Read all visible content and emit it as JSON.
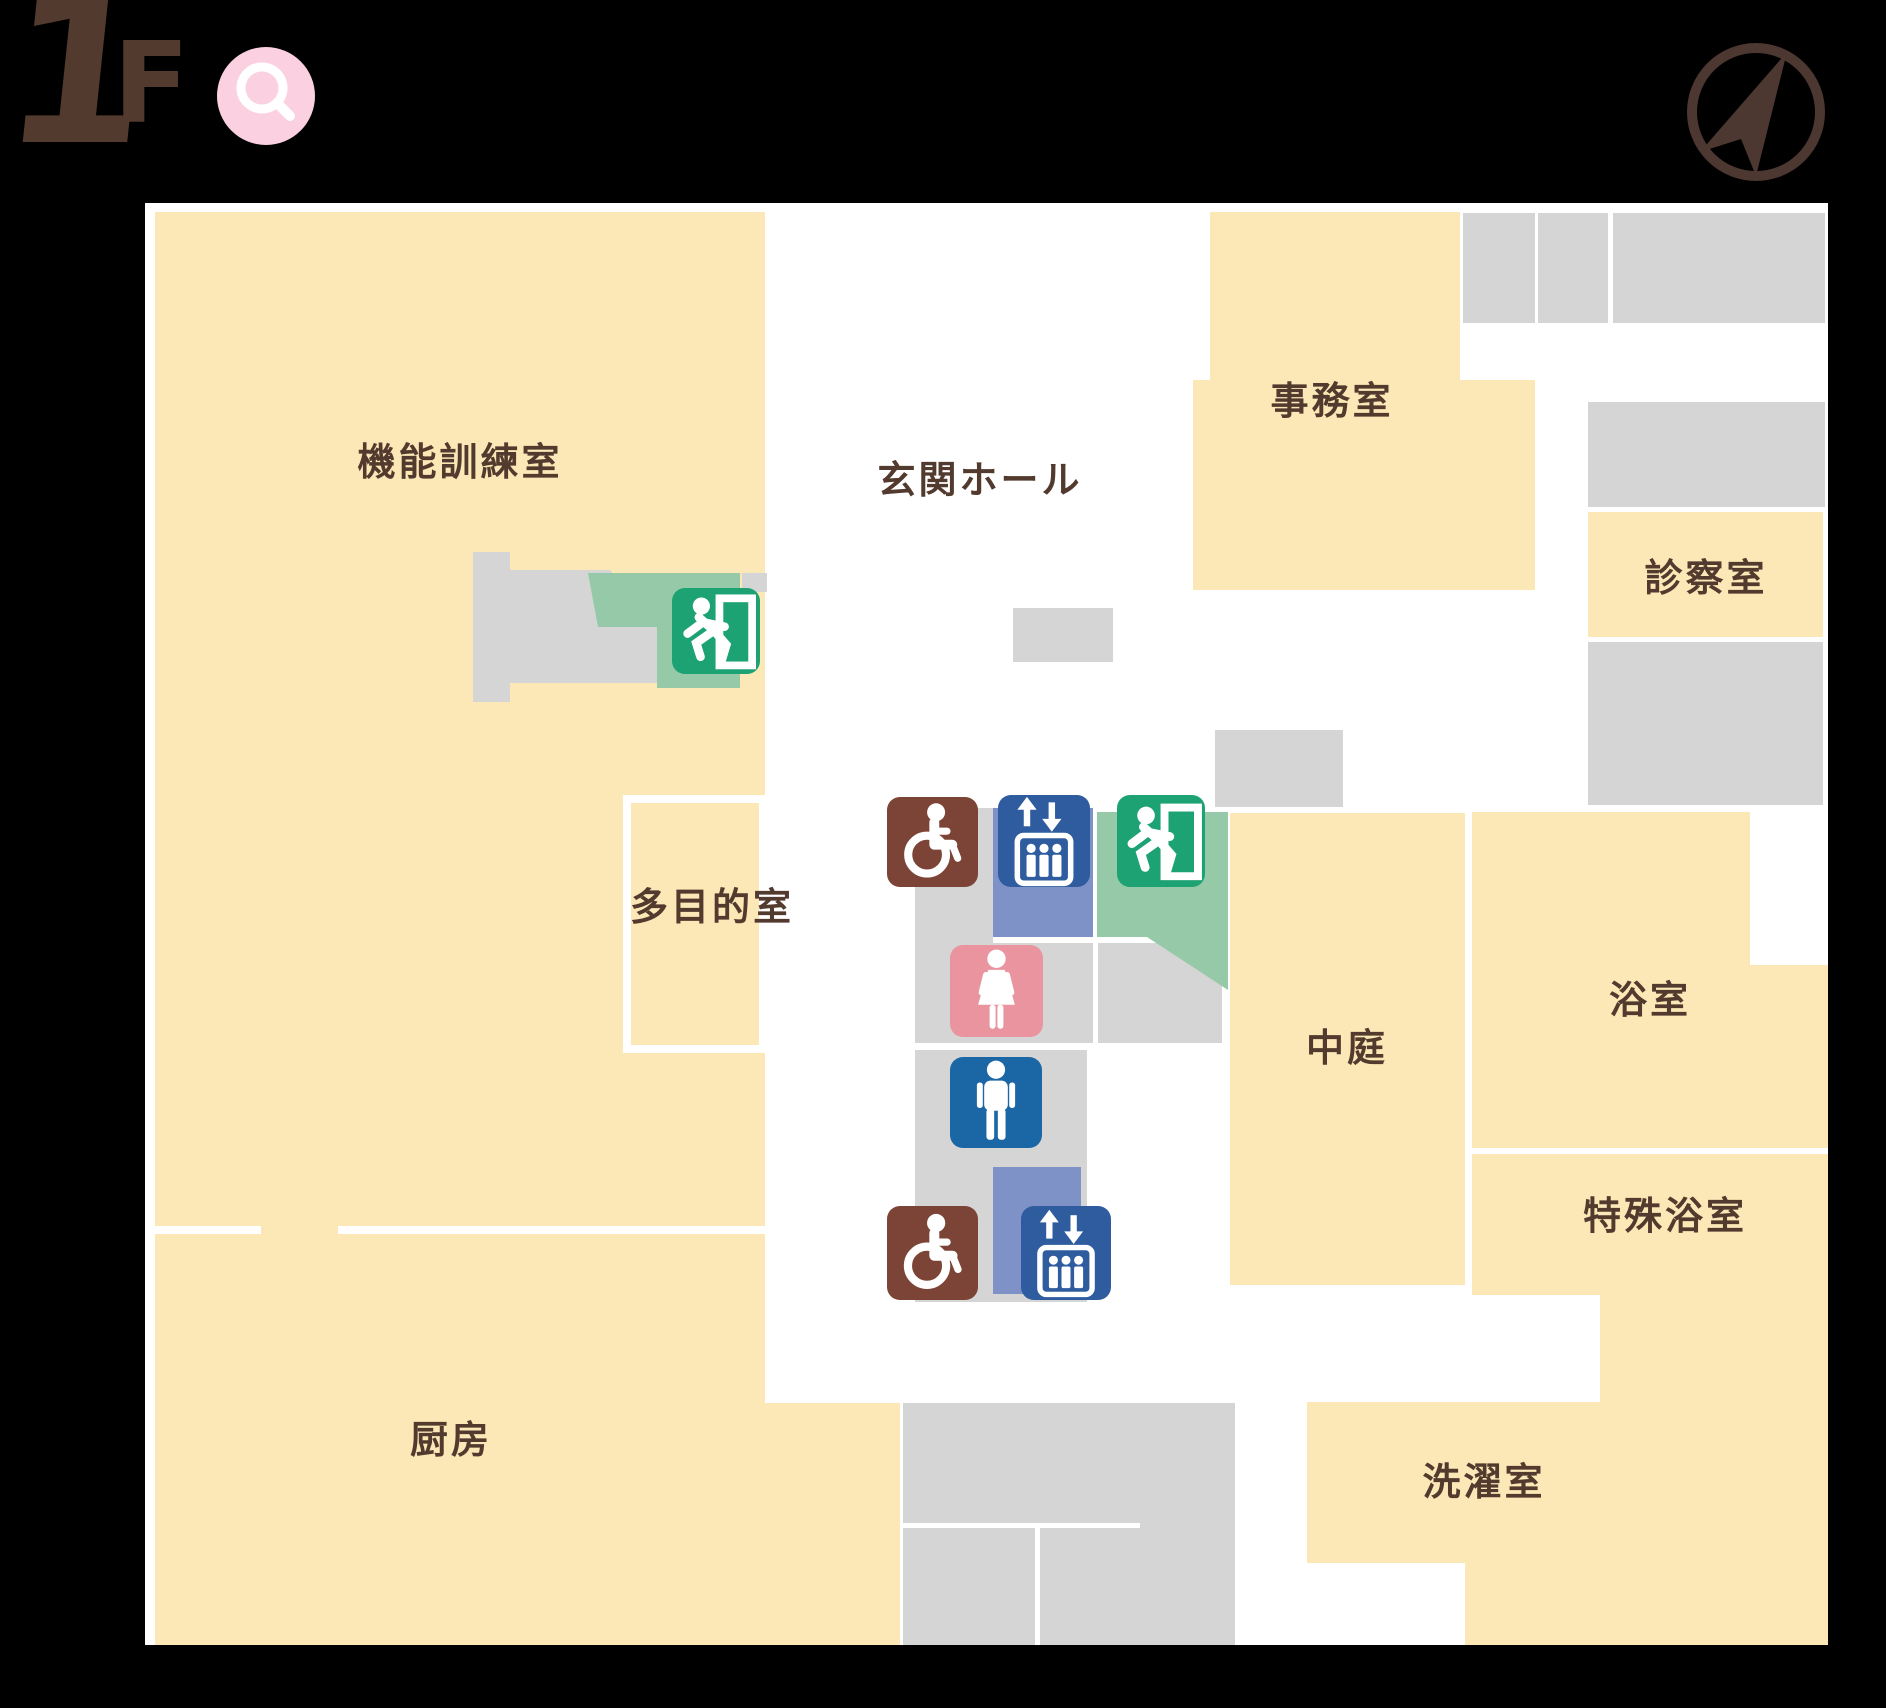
{
  "floor_indicator": {
    "number": "1",
    "suffix": "F"
  },
  "rooms": {
    "training": {
      "label": "機能訓練室"
    },
    "entrance_hall": {
      "label": "玄関ホール"
    },
    "office": {
      "label": "事務室"
    },
    "examination": {
      "label": "診察室"
    },
    "multipurpose": {
      "label": "多目的室"
    },
    "bath": {
      "label": "浴室"
    },
    "courtyard": {
      "label": "中庭"
    },
    "special_bath": {
      "label": "特殊浴室"
    },
    "kitchen": {
      "label": "厨房"
    },
    "laundry": {
      "label": "洗濯室"
    }
  },
  "icons": {
    "search": "magnifier-icon",
    "compass": "compass-north-icon",
    "emergency_exit": "emergency-exit-running-man-icon",
    "elevator": "elevator-icon",
    "accessible_toilet": "wheelchair-icon",
    "womens_toilet": "womens-toilet-icon",
    "mens_toilet": "mens-toilet-icon"
  },
  "colors": {
    "background": "#000000",
    "plan_white": "#ffffff",
    "room_fill": "#fbe8b6",
    "corridor_gray": "#d5d5d6",
    "accent_green": "#1ca273",
    "light_green": "#95c9a7",
    "elevator_blue": "#2e5c9e",
    "elevator_zone_blue": "#7e92c8",
    "mens_blue": "#1b67a6",
    "womens_pink": "#e9949e",
    "accessible_brown": "#7c4437",
    "search_pink": "#fbd0e0",
    "label_brown": "#533a2e"
  }
}
